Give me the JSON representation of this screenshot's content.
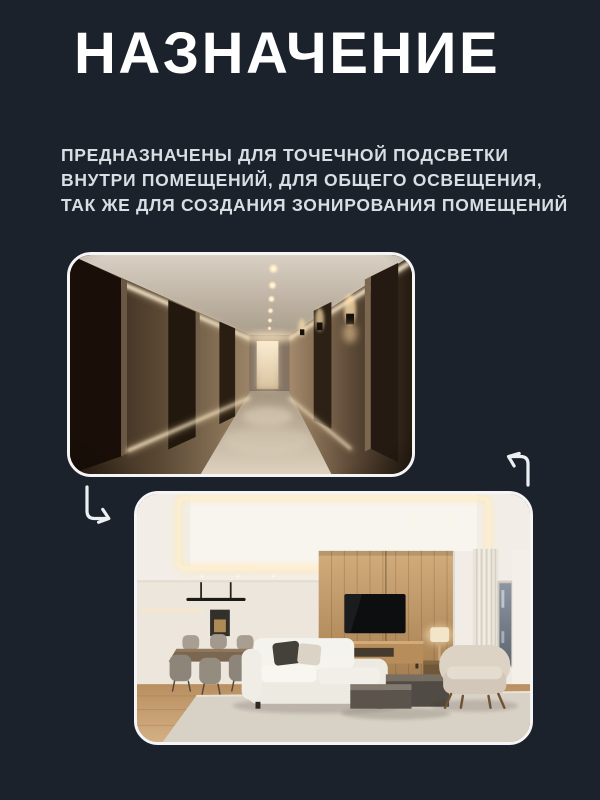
{
  "page": {
    "heading": "НАЗНАЧЕНИЕ",
    "description": {
      "lines": [
        "ПРЕДНАЗНАЧЕНЫ ДЛЯ ТОЧЕЧНОЙ ПОДСВЕТКИ",
        "ВНУТРИ ПОМЕЩЕНИЙ, ДЛЯ ОБЩЕГО ОСВЕЩЕНИЯ,",
        "ТАК ЖЕ ДЛЯ СОЗДАНИЯ ЗОНИРОВАНИЯ ПОМЕЩЕНИЙ"
      ]
    },
    "photos": {
      "corridor": {
        "label": "Коридор с точечной подсветкой и настенными светильниками"
      },
      "living_room": {
        "label": "Гостиная с точечным освещением и световым зонированием"
      }
    },
    "icons": {
      "top_arrow": "turn-up-left-arrow",
      "side_arrow": "turn-down-right-arrow"
    },
    "colors": {
      "background": "#1b222c",
      "heading_text": "#ffffff",
      "body_text": "#d9dee3",
      "card_border": "#f5f5f5",
      "arrow_stroke": "#edf0f3",
      "warm_light_accent": "#ffe9c2"
    }
  }
}
